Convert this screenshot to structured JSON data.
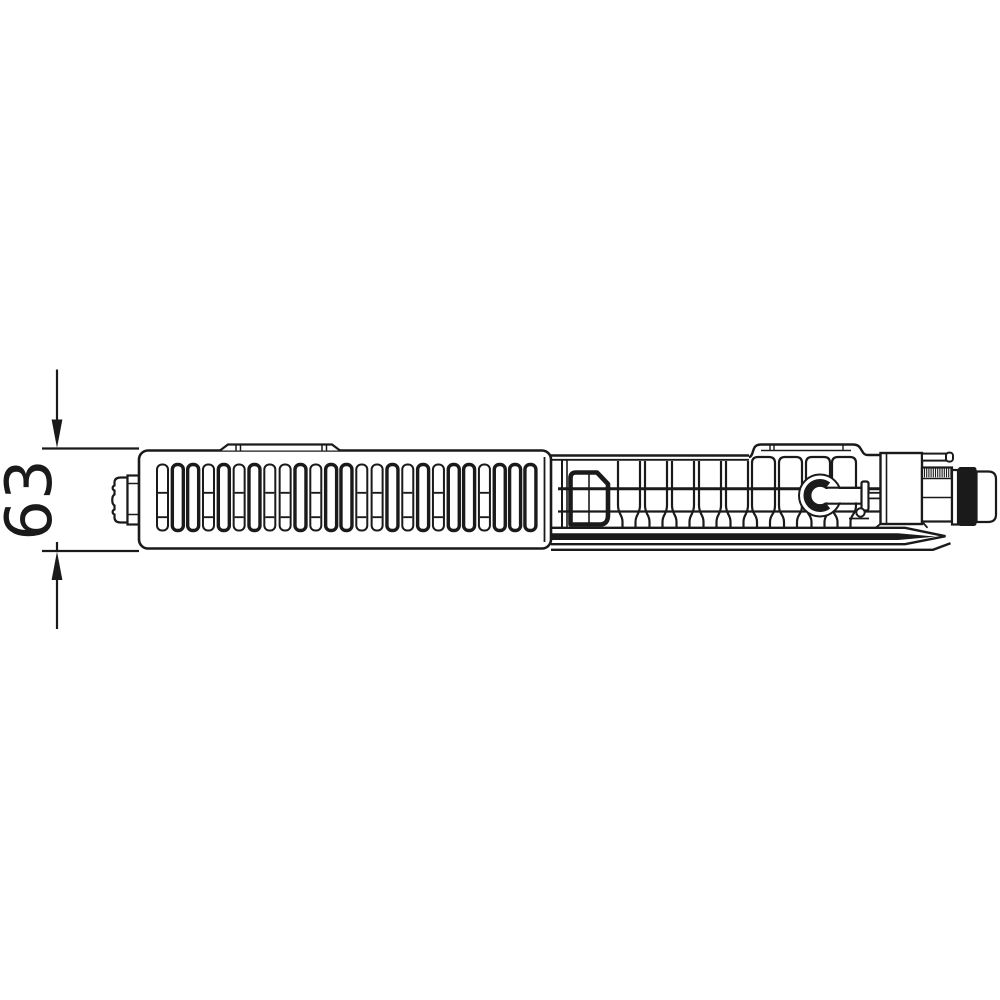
{
  "figure": {
    "background_color": "#ffffff",
    "line_color": "#1a1a1a",
    "valve_ring_fill": "#1a1a1a",
    "dimension": {
      "label": "63"
    }
  }
}
